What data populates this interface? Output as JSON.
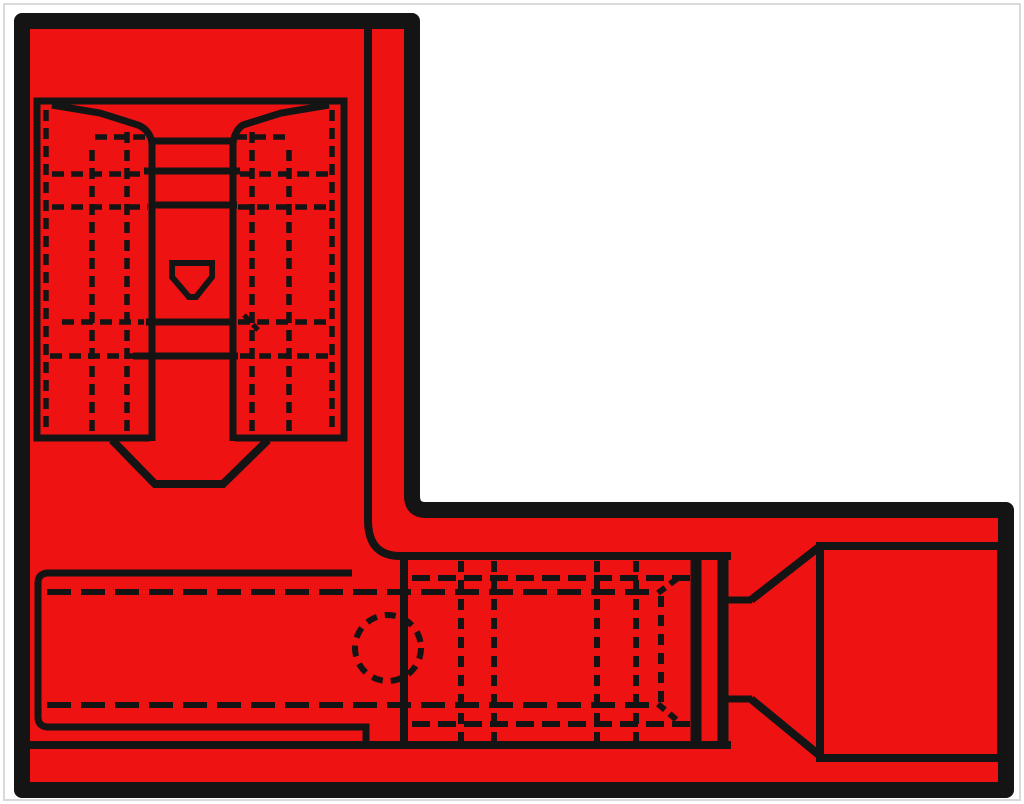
{
  "title": "Technical line drawing of a red insulated flag-type quick-disconnect crimp terminal",
  "colors": {
    "background": "#ffffff",
    "frame": "#d9d9d9",
    "body_red": "#ee1212",
    "line_black": "#141414"
  },
  "diagram": {
    "shape": "L-shaped red terminal body with thick black outline",
    "views": {
      "top_view_flag": [
        "receptacle outline",
        "crimp wings",
        "wire channel with rungs",
        "detent dimple",
        "entry bevel",
        "dashed hidden edges"
      ],
      "side_view_barrel": [
        "hidden sleeve outline (dashed)",
        "inspection hole (dashed circle)",
        "sleeve mouth edge",
        "barrel serrations (dashed)",
        "end flange",
        "neck",
        "wire entry funnel",
        "sleeve end block"
      ]
    },
    "line_styles": [
      "solid visible edges",
      "dashed hidden edges"
    ]
  }
}
